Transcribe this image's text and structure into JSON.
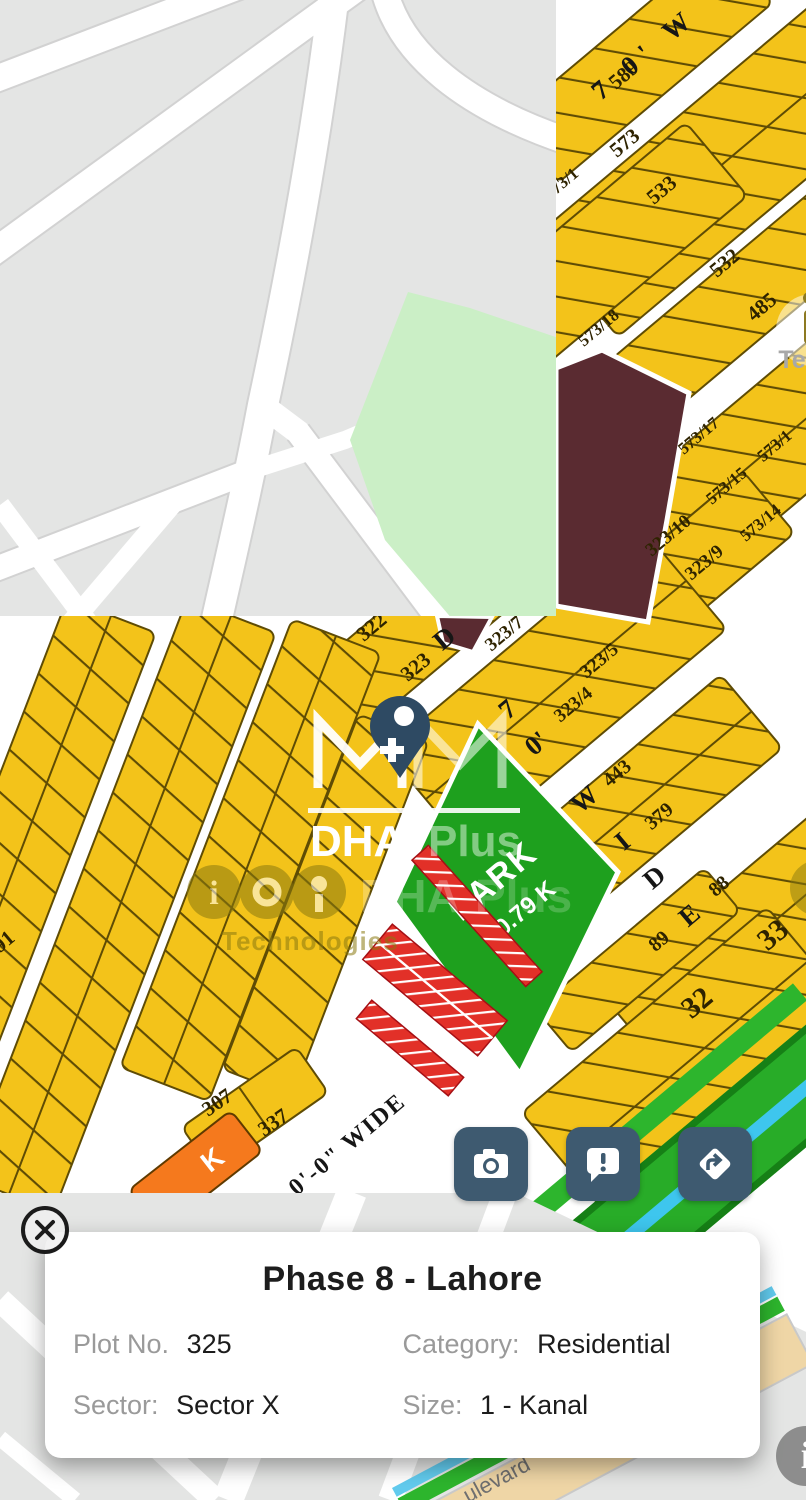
{
  "map": {
    "park": {
      "label": "PARK",
      "size": "10.79 K"
    },
    "plot_labels": {
      "p589": "589",
      "p573": "573",
      "p533": "533",
      "p532": "532",
      "p485": "485",
      "p573_1a": "73/1",
      "p573_18": "573/18",
      "p573_17": "573/17",
      "p573_15": "573/15",
      "p573_1b": "573/1",
      "p573_14": "573/14",
      "p323_10": "323/10",
      "p323_9": "323/9",
      "p322": "322",
      "p323": "323",
      "p323_7": "323/7",
      "p323_5": "323/5",
      "p323_4": "323/4",
      "p443": "443",
      "p379": "379",
      "p88": "88",
      "p33": "33",
      "p89": "89",
      "p32": "32",
      "p591": "591",
      "p307": "307",
      "p337": "337",
      "orange_k": "K"
    },
    "road_labels": {
      "top": "7 0' W",
      "mid_letters": [
        "7",
        "0'",
        "W",
        "I",
        "D",
        "E"
      ],
      "d_letter": "D",
      "bottom": "0'-0\" WIDE",
      "boulevard": "ulevard"
    },
    "watermarks": {
      "dha": "DHA.",
      "plus": "Plus",
      "dha_echo": "DHA",
      "plus_echo": "Plus",
      "technologies": "Technologies",
      "te": "Te"
    }
  },
  "action_buttons": [
    {
      "icon": "camera-icon"
    },
    {
      "icon": "report-chat-icon",
      "glyph": "!"
    },
    {
      "icon": "directions-icon"
    }
  ],
  "info_card": {
    "title": "Phase 8 - Lahore",
    "rows": [
      [
        {
          "label": "Plot No.",
          "value": "325"
        },
        {
          "label": "Category:",
          "value": "Residential"
        }
      ],
      [
        {
          "label": "Sector:",
          "value": "Sector X"
        },
        {
          "label": "Size:",
          "value": "1 - Kanal"
        }
      ]
    ]
  },
  "info_fab": {
    "glyph": "i"
  }
}
